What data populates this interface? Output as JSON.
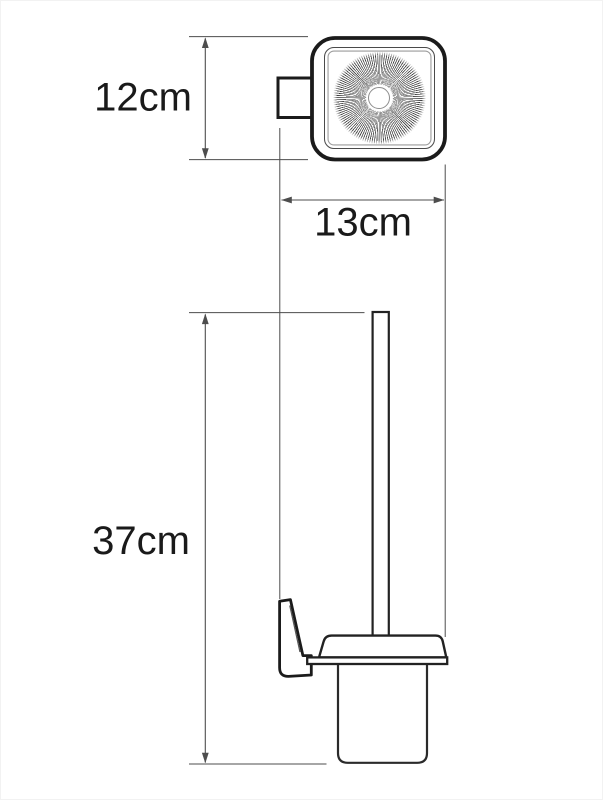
{
  "drawing": {
    "labels": {
      "top_height": "12cm",
      "width": "13cm",
      "total_height": "37cm"
    },
    "dimensions_cm": {
      "holder_top_height": 12,
      "holder_width": 13,
      "total_height": 37
    },
    "colors": {
      "outline": "#1b1b1b",
      "dimension_line": "#4d4d4d",
      "text": "#1a1a1a",
      "background": "#ffffff"
    }
  }
}
